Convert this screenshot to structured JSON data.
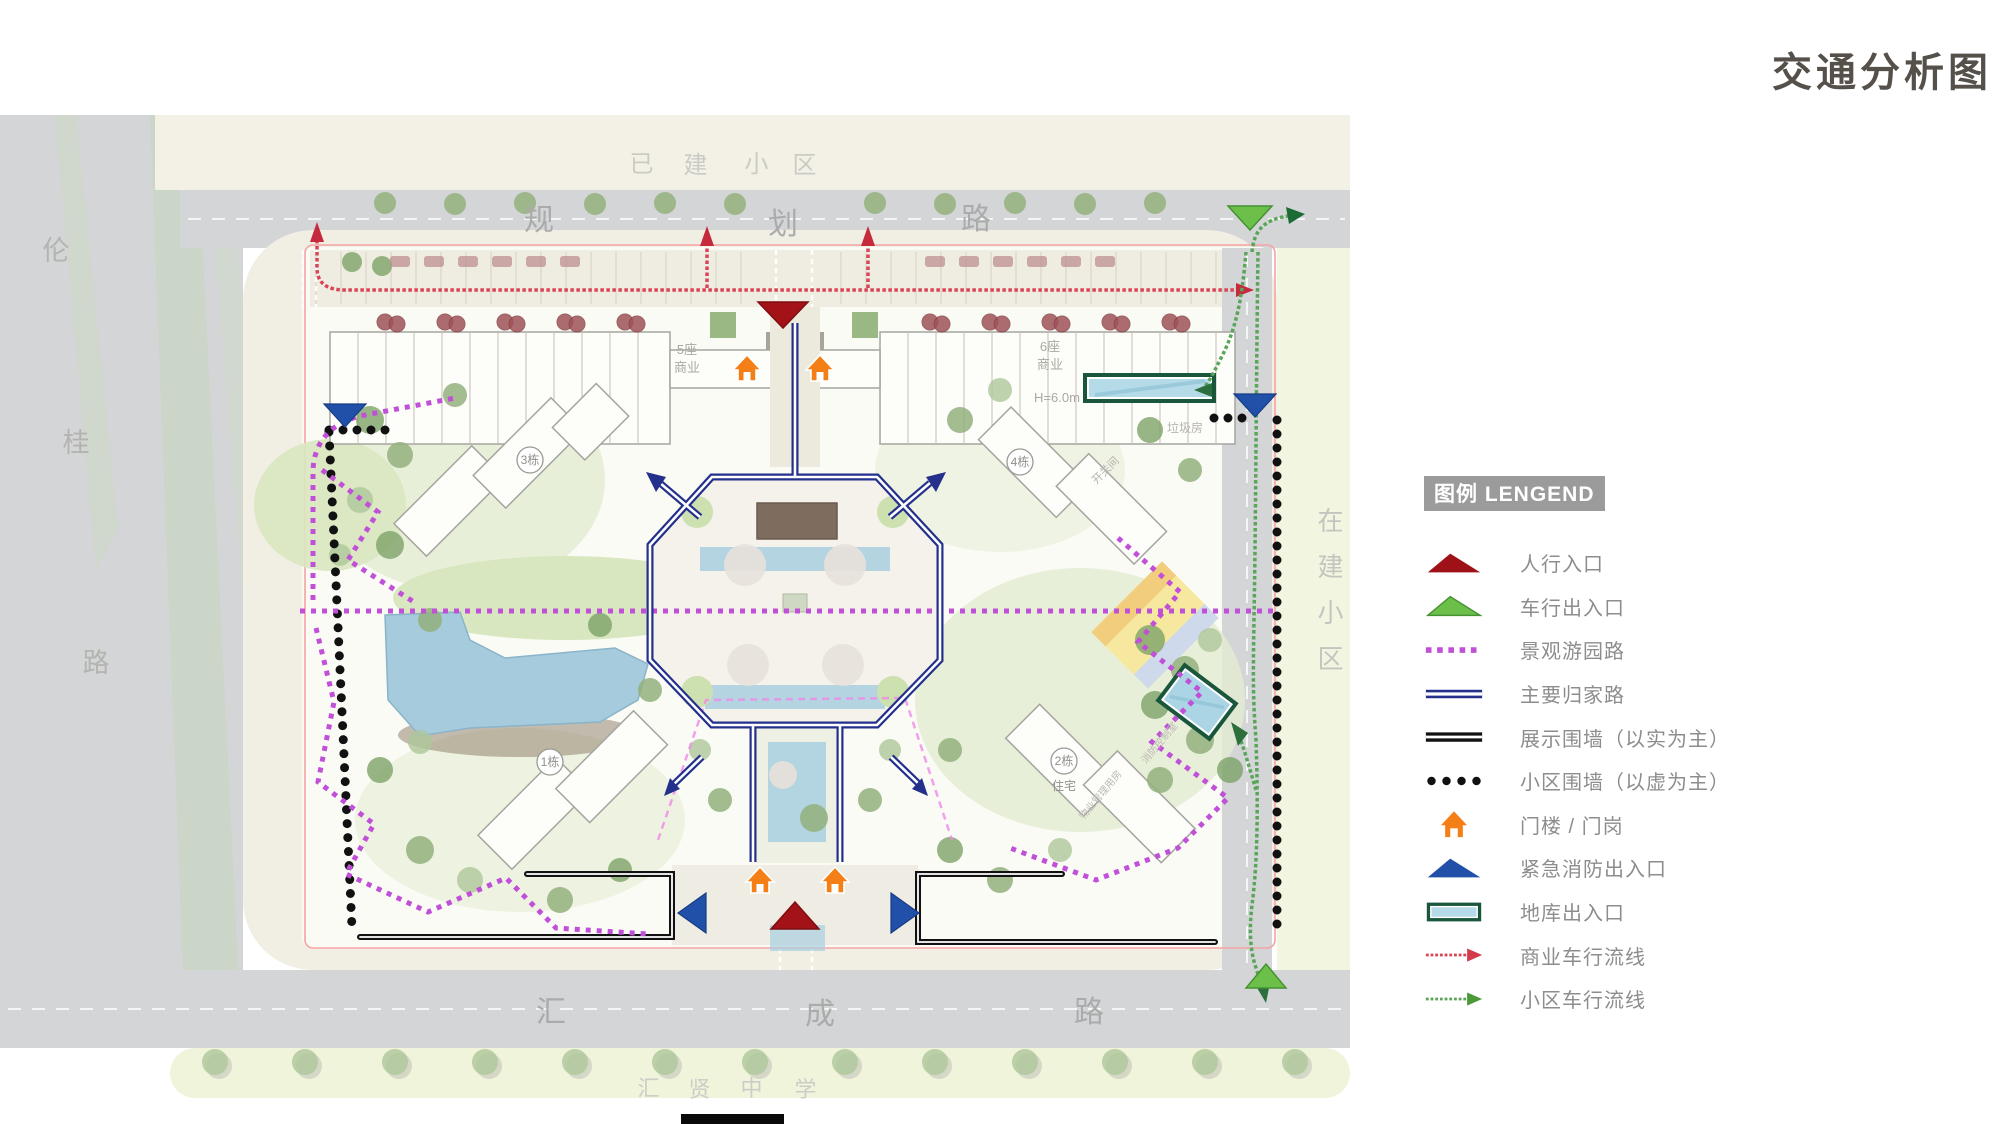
{
  "title": "交通分析图",
  "legend": {
    "header": "图例 LENGEND",
    "items": [
      {
        "key": "pedestrian-entrance",
        "label": "人行入口",
        "color": "#a21217"
      },
      {
        "key": "vehicle-entrance",
        "label": "车行出入口",
        "color": "#6cc04a"
      },
      {
        "key": "landscape-garden-path",
        "label": "景观游园路",
        "color": "#c050d8"
      },
      {
        "key": "main-home-route",
        "label": "主要归家路",
        "color": "#23308c"
      },
      {
        "key": "display-wall",
        "label": "展示围墙（以实为主）",
        "color": "#121212"
      },
      {
        "key": "community-wall",
        "label": "小区围墙（以虚为主）",
        "color": "#111111"
      },
      {
        "key": "gate-house",
        "label": "门楼 / 门岗",
        "color": "#f57f17"
      },
      {
        "key": "emergency-fire-exit",
        "label": "紧急消防出入口",
        "color": "#2150a8"
      },
      {
        "key": "garage-entrance",
        "label": "地库出入口",
        "color": "#b5dbe9"
      },
      {
        "key": "commercial-vehicle-flow",
        "label": "商业车行流线",
        "color": "#d94456"
      },
      {
        "key": "community-vehicle-flow",
        "label": "小区车行流线",
        "color": "#5aa55a"
      }
    ]
  },
  "map": {
    "roads": {
      "top": {
        "name": "规划路",
        "chars": [
          "规",
          "划",
          "路"
        ]
      },
      "bottom": {
        "name": "汇成路",
        "chars": [
          "汇",
          "成",
          "路"
        ]
      },
      "left": {
        "name": "伦桂路",
        "chars": [
          "伦",
          "桂",
          "路"
        ]
      },
      "adjacent_top": {
        "name": "已建小区",
        "chars": [
          "已",
          "建",
          "小",
          "区"
        ]
      },
      "adjacent_right": {
        "name": "在建小区",
        "chars": [
          "在",
          "建",
          "小",
          "区"
        ]
      },
      "school": {
        "name": "汇贤中学",
        "chars": [
          "汇",
          "贤",
          "中",
          "学"
        ]
      }
    },
    "labels": {
      "bldg3": "3栋",
      "bldg4": "4栋",
      "bldg1": "1栋",
      "bldg2": "2栋",
      "bldg2_use": "住宅",
      "c5_line1": "5座",
      "c5_line2": "商业",
      "c6_line1": "6座",
      "c6_line2": "商业",
      "height": "H=6.0m",
      "garbage": "垃圾房",
      "switch_room": "开关间",
      "property_mgmt": "物业管理用房",
      "fire_control": "消防控制室"
    },
    "colors": {
      "main_route_blue": "#23308c",
      "landscape_purple": "#c050d8",
      "commercial_flow_red": "#d94456",
      "community_flow_green": "#5aa55a",
      "pedestrian_red": "#a21217",
      "vehicle_green": "#6cc04a",
      "emergency_blue": "#2150a8",
      "gate_orange": "#f57f17",
      "garage_fill": "#b5dbe9",
      "garage_border": "#19563c",
      "road_gray": "#d3d5d7",
      "sidewalk_cream": "#f1efe4",
      "pond_blue": "#a5cbdd"
    }
  }
}
